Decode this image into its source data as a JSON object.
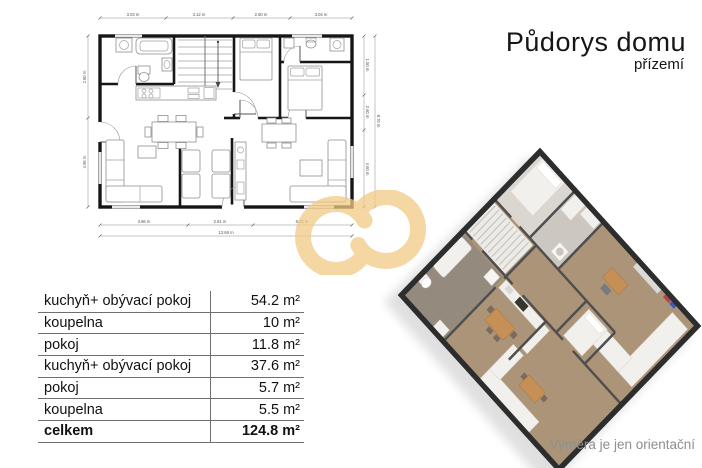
{
  "header": {
    "title": "Půdorys domu",
    "subtitle": "přízemí",
    "text_color": "#161616"
  },
  "table": {
    "rows": [
      {
        "label": "kuchyň+ obývací pokoj",
        "value": "54.2 m²",
        "bold": false
      },
      {
        "label": "koupelna",
        "value": "10 m²",
        "bold": false
      },
      {
        "label": "pokoj",
        "value": "11.8 m²",
        "bold": false
      },
      {
        "label": "kuchyň+ obývací pokoj",
        "value": "37.6 m²",
        "bold": false
      },
      {
        "label": "pokoj",
        "value": "5.7 m²",
        "bold": false
      },
      {
        "label": "koupelna",
        "value": "5.5 m²",
        "bold": false
      },
      {
        "label": "celkem",
        "value": "124.8 m²",
        "bold": true
      }
    ]
  },
  "plan2d": {
    "dims_top": [
      "3.03 m",
      "3.12 m",
      "2.50 m",
      "3.04 m"
    ],
    "dims_bottom": [
      "3.86 m",
      "2.81 m",
      "6.82 m"
    ],
    "dim_bottom_total": "13.66 m",
    "dims_left": [
      "2.80 m",
      "4.95 m"
    ],
    "dims_right": [
      "1.50 m",
      "2.60 m",
      "4.60 m"
    ],
    "dim_right_total": "8.70 m"
  },
  "plan3d": {
    "wall_color": "#2d2d2d",
    "interior_wall_color": "#4f4f4f",
    "floor_wood": "#ac9478",
    "floor_light": "#dbd7d0",
    "floor_bath": "#948a7e",
    "furniture_color": "#f2f0ec",
    "wood_furniture_color": "#c58f55"
  },
  "watermark": {
    "color": "#f2ca86",
    "opacity": "0.75"
  },
  "disclaimer": {
    "text": "Výměra je jen orientační",
    "color": "#8f8f8f"
  }
}
